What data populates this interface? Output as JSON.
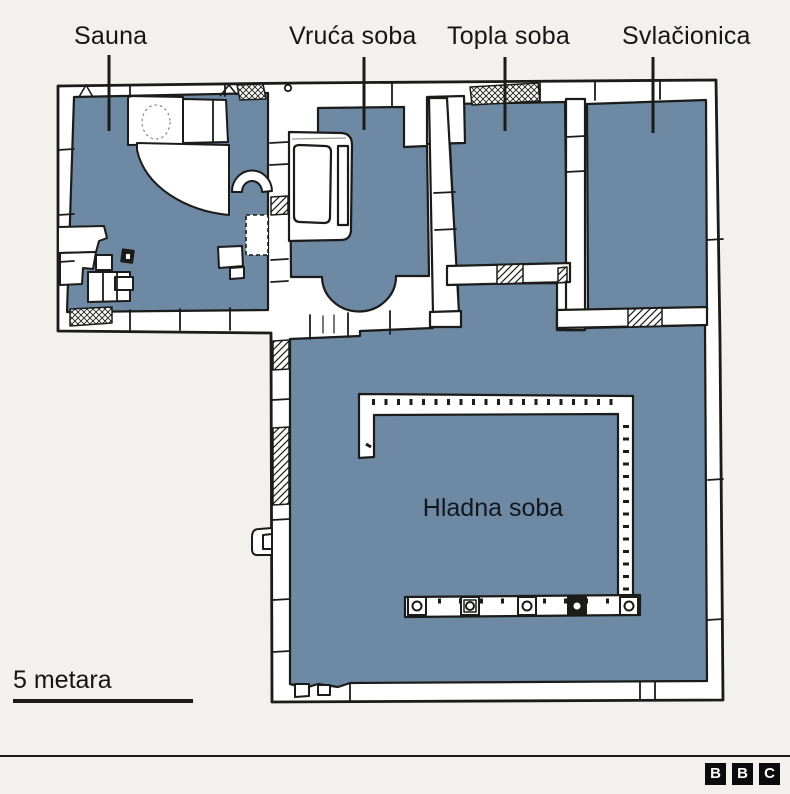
{
  "labels": {
    "sauna": "Sauna",
    "vruca_soba": "Vruća soba",
    "topla_soba": "Topla soba",
    "svlacionica": "Svlačionica",
    "hladna_soba": "Hladna soba"
  },
  "scale_bar": {
    "label": "5 metara"
  },
  "logo": {
    "letters": [
      "B",
      "B",
      "C"
    ]
  },
  "colors": {
    "background": "#f2f1ee",
    "room_fill": "#6d89a3",
    "ink": "#1b1b19",
    "paper": "#ffffff"
  }
}
